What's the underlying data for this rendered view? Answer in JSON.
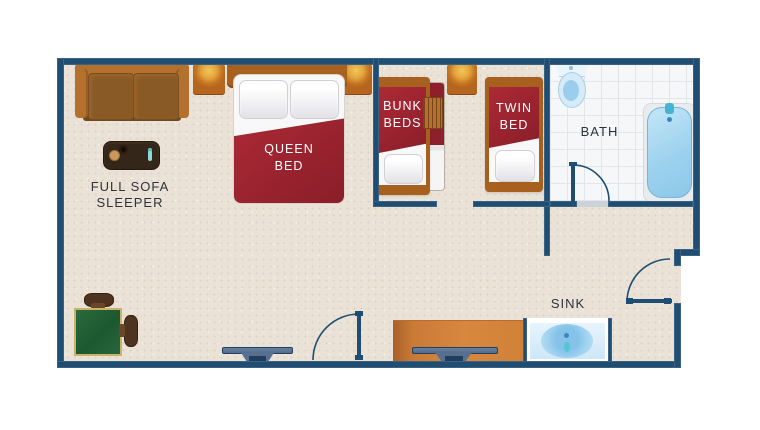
{
  "page": {
    "type": "hotel-room-floor-plan"
  },
  "labels": {
    "sofa_area": "FULL SOFA SLEEPER",
    "queen_bed": "QUEEN BED",
    "bunk_beds": "BUNK BEDS",
    "twin_bed": "TWIN BED",
    "bath": "BATH",
    "sink": "SINK"
  },
  "colors": {
    "wall": "#1f4e72",
    "floor": "#eae2d6",
    "bath_tile": "#f5f7f8",
    "bed_red": "#9c2430",
    "wood_brown": "#a8601f",
    "sofa_brown": "#b4712e",
    "cushion_brown": "#8a5a26",
    "dresser_orange": "#cf7f3c",
    "fixture_blue": "#a9d8f2",
    "table_green": "#226338",
    "label_dark": "#2e333c",
    "label_light": "#ffffff"
  },
  "furniture_icons": [
    "sofa-sleeper-icon",
    "coffee-table-icon",
    "nightstand-lamp-icon",
    "queen-bed-icon",
    "bunk-beds-icon",
    "bunk-ladder-icon",
    "twin-bed-icon",
    "toilet-icon",
    "bathtub-icon",
    "sink-basin-icon",
    "tv-icon",
    "dresser-icon",
    "dining-table-icon",
    "chair-icon",
    "door-swing-icon"
  ]
}
